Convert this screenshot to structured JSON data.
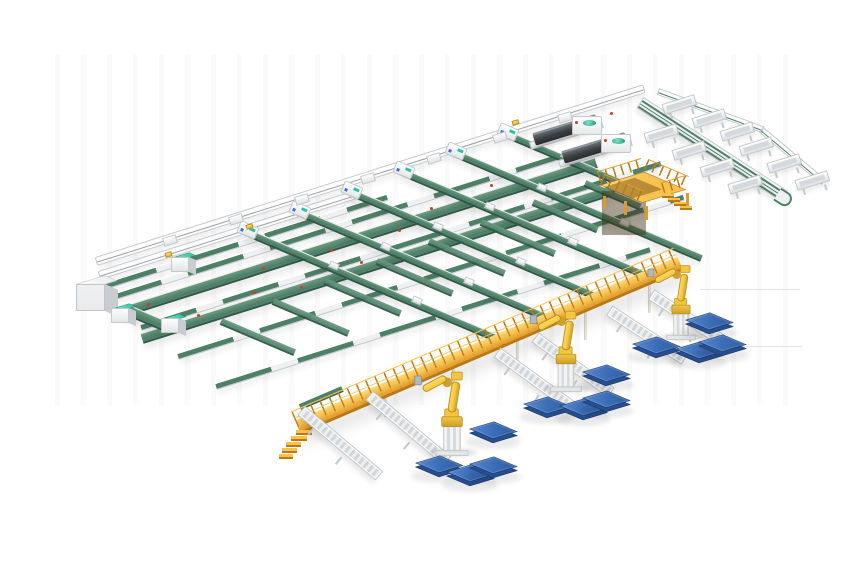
{
  "meta": {
    "scene_width": 860,
    "scene_height": 580
  },
  "inventory": {
    "sorter_lines": 6,
    "cross_lines": 5,
    "green_avenues": 2,
    "trunk_conveyors": 2,
    "telescopic_loaders": 2,
    "chute_bins": 10,
    "palletizing_robots": 3,
    "pallets": 12,
    "outfeed_conveyors": 6,
    "teal_machines": 3,
    "mezzanine_platforms": 1,
    "elevated_walkways": 1,
    "control_cabinets": 1
  },
  "colors": {
    "bg": "#ffffff",
    "frame": "#f2f3f5",
    "frame_edge": "#c6c9cc",
    "rail_dark": "#9aa0a4",
    "belt": "#4e7f67",
    "belt_light": "#6e9c85",
    "belt_dark": "#2f5847",
    "teal": "#2ec3a0",
    "teal_light": "#7fe3c9",
    "teal_dark": "#1e8f72",
    "yellow": "#f7c14e",
    "yellow_light": "#ffd97c",
    "yellow_dark": "#e09a2b",
    "yellow_deep": "#b97a16",
    "robot": "#f2c63e",
    "robot_dark": "#cfa02a",
    "metal": "#b3b8bd",
    "dark": "#3c4044",
    "dark_top": "#676d72",
    "blue": "#3a6cb5",
    "blue_side": "#274f8e",
    "blue_dark": "#1c3a6b",
    "red": "#cf3b28",
    "cab": "#e8eaec",
    "cab_side": "#c9ccd0",
    "roller": "#d3d6d9",
    "streak": "#dcdcdc",
    "accent_blue": "#3e6fd6"
  },
  "streaks": [
    {
      "x": 700,
      "y": 289,
      "l": 100
    },
    {
      "x": 677,
      "y": 346,
      "l": 125
    }
  ],
  "trunks": [
    {
      "x": 96,
      "y": 257,
      "l": 575
    },
    {
      "x": 99,
      "y": 271,
      "l": 270
    }
  ],
  "modules": [
    {
      "x": 163,
      "y": 236
    },
    {
      "x": 229,
      "y": 215
    },
    {
      "x": 295,
      "y": 195
    },
    {
      "x": 361,
      "y": 174
    },
    {
      "x": 427,
      "y": 154
    },
    {
      "x": 493,
      "y": 133
    },
    {
      "x": 558,
      "y": 113
    }
  ],
  "packages": [
    {
      "x": 165,
      "y": 252
    },
    {
      "x": 512,
      "y": 120
    },
    {
      "x": 246,
      "y": 224
    }
  ],
  "cross_lines": [
    {
      "x": 101,
      "y": 284,
      "l": 300
    },
    {
      "x": 106,
      "y": 296,
      "l": 545
    },
    {
      "x": 141,
      "y": 324,
      "l": 545
    },
    {
      "x": 178,
      "y": 353,
      "l": 530
    },
    {
      "x": 216,
      "y": 383,
      "l": 455
    }
  ],
  "avenues": [
    {
      "x": 124,
      "y": 306,
      "l": 495
    },
    {
      "x": 142,
      "y": 333,
      "l": 495
    }
  ],
  "teal_boxes": [
    {
      "x": 111,
      "y": 301
    },
    {
      "x": 161,
      "y": 311
    },
    {
      "x": 171,
      "y": 250
    }
  ],
  "sorters": [
    {
      "x": 246,
      "y": 228,
      "l": 282
    },
    {
      "x": 298,
      "y": 208,
      "l": 279
    },
    {
      "x": 350,
      "y": 188,
      "l": 276
    },
    {
      "x": 402,
      "y": 168,
      "l": 273
    },
    {
      "x": 454,
      "y": 149,
      "l": 269
    },
    {
      "x": 506,
      "y": 130,
      "l": 150
    }
  ],
  "short_belts": [
    {
      "x": 273,
      "y": 298,
      "l": 82
    },
    {
      "x": 325,
      "y": 278,
      "l": 82
    },
    {
      "x": 377,
      "y": 258,
      "l": 82
    },
    {
      "x": 429,
      "y": 238,
      "l": 82
    },
    {
      "x": 481,
      "y": 219,
      "l": 80
    },
    {
      "x": 533,
      "y": 199,
      "l": 70
    },
    {
      "x": 585,
      "y": 180,
      "l": 60
    },
    {
      "x": 221,
      "y": 318,
      "l": 80
    }
  ],
  "carts": [
    {
      "x": 329,
      "y": 262
    },
    {
      "x": 412,
      "y": 297
    },
    {
      "x": 381,
      "y": 243
    },
    {
      "x": 464,
      "y": 278
    },
    {
      "x": 433,
      "y": 223
    },
    {
      "x": 516,
      "y": 258
    },
    {
      "x": 485,
      "y": 203
    },
    {
      "x": 568,
      "y": 238
    },
    {
      "x": 537,
      "y": 184
    },
    {
      "x": 561,
      "y": 152
    },
    {
      "x": 620,
      "y": 219
    }
  ],
  "red_dots": [
    {
      "x": 147,
      "y": 303
    },
    {
      "x": 197,
      "y": 314
    },
    {
      "x": 253,
      "y": 291
    },
    {
      "x": 262,
      "y": 267
    },
    {
      "x": 330,
      "y": 249
    },
    {
      "x": 398,
      "y": 229
    },
    {
      "x": 300,
      "y": 286
    },
    {
      "x": 360,
      "y": 261
    },
    {
      "x": 430,
      "y": 207
    },
    {
      "x": 490,
      "y": 184
    },
    {
      "x": 560,
      "y": 135
    },
    {
      "x": 610,
      "y": 112
    }
  ],
  "loaders": [
    {
      "x": 534,
      "y": 133
    },
    {
      "x": 563,
      "y": 151
    }
  ],
  "bins": [
    {
      "x": 645,
      "y": 133
    },
    {
      "x": 673,
      "y": 150
    },
    {
      "x": 701,
      "y": 167
    },
    {
      "x": 729,
      "y": 184
    },
    {
      "x": 740,
      "y": 146
    },
    {
      "x": 768,
      "y": 163
    },
    {
      "x": 796,
      "y": 180
    },
    {
      "x": 663,
      "y": 104
    },
    {
      "x": 693,
      "y": 118
    },
    {
      "x": 721,
      "y": 131
    }
  ],
  "mezz_rails": [
    {
      "x": 600,
      "y": 171,
      "l": 46,
      "r": -17
    },
    {
      "x": 644,
      "y": 158,
      "l": 44,
      "r": 23
    },
    {
      "x": 600,
      "y": 173,
      "l": 44,
      "r": 23
    },
    {
      "x": 664,
      "y": 182,
      "l": 24,
      "r": -17
    }
  ],
  "mezz_legs": [
    {
      "x": 603,
      "y": 196,
      "h": 13
    },
    {
      "x": 645,
      "y": 206,
      "h": 14
    },
    {
      "x": 686,
      "y": 193,
      "h": 13
    },
    {
      "x": 624,
      "y": 201,
      "h": 14
    }
  ],
  "mezz_steps": [
    {
      "x": 662,
      "y": 194
    },
    {
      "x": 668,
      "y": 198
    },
    {
      "x": 674,
      "y": 202
    },
    {
      "x": 680,
      "y": 206
    }
  ],
  "ramp_steps": [
    {
      "x": 296,
      "y": 430,
      "w": 16
    },
    {
      "x": 291,
      "y": 436,
      "w": 16
    },
    {
      "x": 286,
      "y": 442,
      "w": 15
    },
    {
      "x": 282,
      "y": 448,
      "w": 15
    },
    {
      "x": 279,
      "y": 454,
      "w": 14
    }
  ],
  "walk_legs": [
    {
      "x": 322,
      "y": 416,
      "h": 20
    },
    {
      "x": 384,
      "y": 391,
      "h": 26
    },
    {
      "x": 452,
      "y": 362,
      "h": 30
    },
    {
      "x": 516,
      "y": 335,
      "h": 32
    },
    {
      "x": 584,
      "y": 306,
      "h": 34
    },
    {
      "x": 648,
      "y": 279,
      "h": 34
    }
  ],
  "stubs": [
    {
      "x": 302,
      "y": 406,
      "l": 100,
      "r": 40
    },
    {
      "x": 370,
      "y": 391,
      "l": 100,
      "r": 40
    },
    {
      "x": 498,
      "y": 348,
      "l": 92,
      "r": 36
    },
    {
      "x": 536,
      "y": 333,
      "l": 92,
      "r": 36
    },
    {
      "x": 610,
      "y": 306,
      "l": 88,
      "r": 33
    },
    {
      "x": 652,
      "y": 290,
      "l": 84,
      "r": 33
    }
  ],
  "robots": [
    {
      "x": 452,
      "y": 456,
      "s": 0.97
    },
    {
      "x": 566,
      "y": 392,
      "s": 0.93
    },
    {
      "x": 681,
      "y": 340,
      "s": 0.86
    }
  ],
  "pallets": [
    {
      "x": 685,
      "y": 320
    },
    {
      "x": 632,
      "y": 344
    },
    {
      "x": 675,
      "y": 349
    },
    {
      "x": 698,
      "y": 342
    },
    {
      "x": 582,
      "y": 372
    },
    {
      "x": 523,
      "y": 404
    },
    {
      "x": 559,
      "y": 406
    },
    {
      "x": 582,
      "y": 398
    },
    {
      "x": 469,
      "y": 429
    },
    {
      "x": 415,
      "y": 463
    },
    {
      "x": 446,
      "y": 472
    },
    {
      "x": 469,
      "y": 464
    }
  ]
}
